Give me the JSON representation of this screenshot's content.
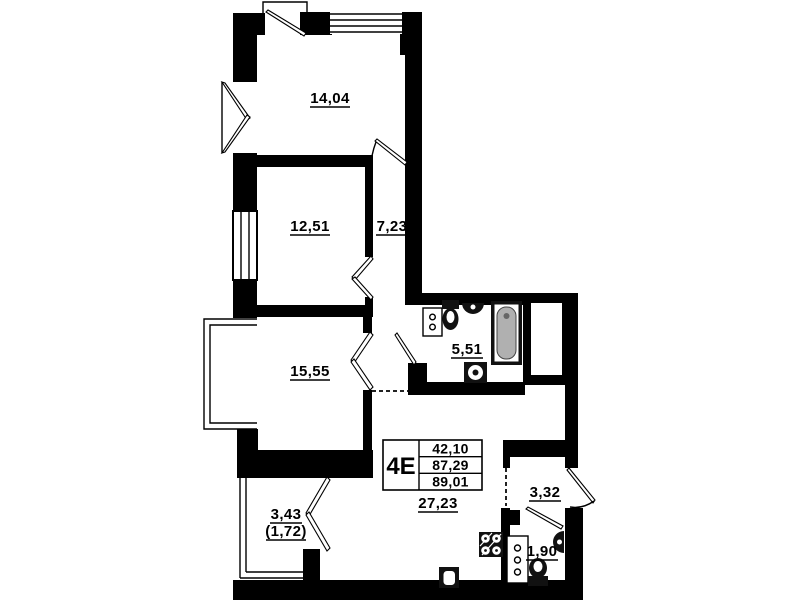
{
  "floor_plan": {
    "unit": {
      "type_label": "4E",
      "areas": [
        "42,10",
        "87,29",
        "89,01"
      ]
    },
    "rooms": {
      "room_top": "14,04",
      "room_mid": "12,51",
      "corridor": "7,23",
      "room_low": "15,55",
      "bathroom": "5,51",
      "kitchen_living": "27,23",
      "entry_hall": "3,32",
      "wc": "1,90",
      "balcony": "3,43",
      "balcony_reduced": "(1,72)"
    },
    "colors": {
      "wall": "#000000",
      "background": "#ffffff",
      "bathtub": "#b0b0b0"
    }
  }
}
